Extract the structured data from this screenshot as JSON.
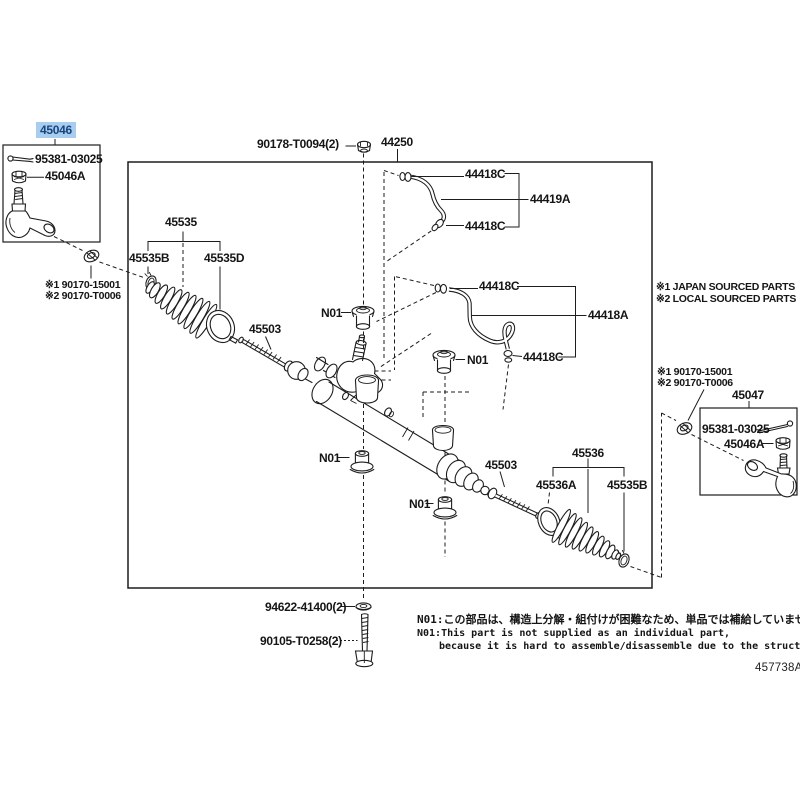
{
  "doc": {
    "number": "457738A"
  },
  "highlight": {
    "selected_part": "45046",
    "bg_color": "#a9cdee",
    "text_color": "#17457e"
  },
  "callouts": {
    "selected_tie_rod_end": "45046",
    "cotter_pin_left": "95381-03025",
    "castle_nut_left": "45046A",
    "jam_nut_left_line1": "※1 90170-15001",
    "jam_nut_left_line2": "※2 90170-T0006",
    "pinion_nut": "90178-T0094(2)",
    "gear_assembly": "44250",
    "tube1_clamp_top": "44418C",
    "tube1": "44419A",
    "tube1_clamp_bottom": "44418C",
    "tube2_clamp_top": "44418C",
    "tube2": "44418A",
    "tube2_clamp_bottom": "44418C",
    "boot_left": "45535",
    "boot_left_clamp": "45535B",
    "boot_left_clip": "45535D",
    "tie_rod_left": "45503",
    "grommet": "N01",
    "tie_rod_right": "45503",
    "boot_right": "45536",
    "boot_right_clip": "45536A",
    "boot_right_clamp": "45535B",
    "jam_nut_right_line1": "※1 90170-15001",
    "jam_nut_right_line2": "※2 90170-T0006",
    "tie_rod_end_right": "45047",
    "cotter_pin_right": "95381-03025",
    "castle_nut_right": "45046A",
    "washer": "94622-41400(2)",
    "bolt": "90105-T0258(2)"
  },
  "notes": {
    "sourcing_line1": "※1 JAPAN SOURCED PARTS",
    "sourcing_line2": "※2 LOCAL SOURCED PARTS",
    "footnote_jp": "N01:この部品は、構造上分解・組付けが困難なため、単品では補給していません",
    "footnote_en_line1": "N01:This part is not supplied as an individual part,",
    "footnote_en_line2": "because it is hard to assemble/disassemble due to the structure"
  }
}
